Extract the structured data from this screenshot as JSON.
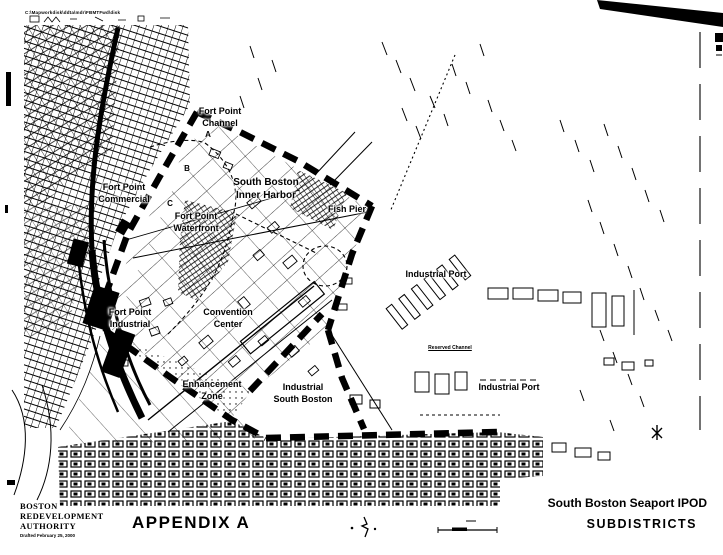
{
  "page": {
    "header_note": "C:\\Mapworkdisk\\ddta\\mdr\\FBMTFwd\\disk",
    "ink_color": "#000000",
    "paper_color": "#ffffff"
  },
  "map": {
    "labels": {
      "fort_point_channel": "Fort Point\nChannel",
      "marker_a": "A",
      "marker_b": "B",
      "marker_c": "C",
      "fort_point_commercial": "Fort Point\nCommercial",
      "south_boston_inner_harbor": "South Boston\nInner Harbor",
      "fort_point_waterfront": "Fort Point\nWaterfront",
      "fish_pier": "Fish Pier",
      "industrial_port_north": "Industrial Port",
      "reserved_channel": "Reserved Channel",
      "fort_point_industrial": "Fort Point\nIndustrial",
      "convention_center": "Convention\nCenter",
      "enhancement_zone": "Enhancement\nZone",
      "industrial_south_boston": "Industrial\nSouth Boston",
      "industrial_port_south": "Industrial Port"
    },
    "symbols": {
      "north_arrow": "north-arrow",
      "scale_bar": "scale-bar",
      "boundary_style": "thick-black-dashed"
    }
  },
  "footer": {
    "agency_line1": "BOSTON",
    "agency_line2": "REDEVELOPMENT",
    "agency_line3": "AUTHORITY",
    "drafted_note": "Drafted February 25, 2000",
    "appendix_title": "APPENDIX A",
    "map_title": "South Boston Seaport IPOD",
    "map_subtitle": "SUBDISTRICTS"
  }
}
